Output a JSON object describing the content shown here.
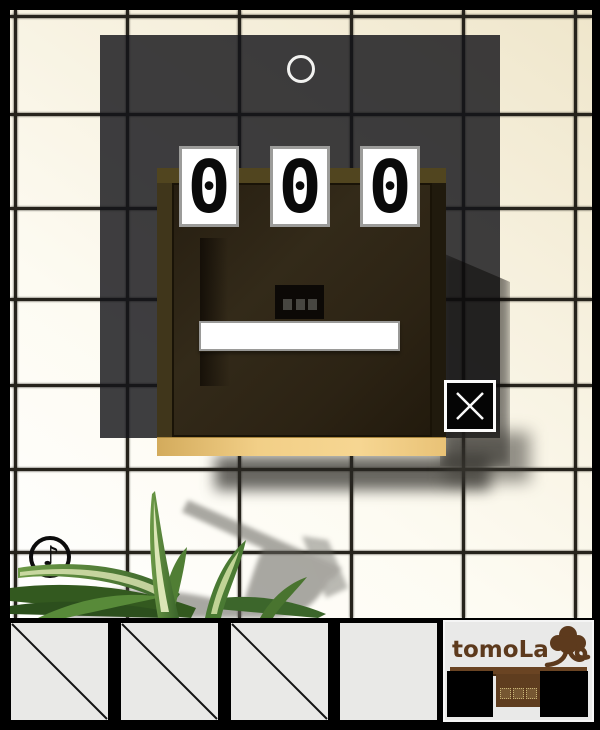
{
  "scene": {
    "dial_digits": [
      "0",
      "0",
      "0"
    ],
    "music_note_glyph": "♪"
  },
  "inventory": {
    "slots": [
      {
        "label": "slot-1",
        "crossed": true
      },
      {
        "label": "slot-2",
        "crossed": true
      },
      {
        "label": "slot-3",
        "crossed": true
      },
      {
        "label": "slot-4",
        "crossed": false
      }
    ]
  },
  "logo": {
    "text": "tomoLa"
  },
  "colors": {
    "wall": "#f7f2e1",
    "tile_line": "#26231c",
    "shadow_panel": "rgba(20,20,24,0.82)",
    "wood_face": "#2e2517",
    "wood_frame_top": "#51451f",
    "wood_base": "#f0cc82",
    "card_bg": "#ffffff",
    "logo_brown": "#5d3a1d"
  }
}
